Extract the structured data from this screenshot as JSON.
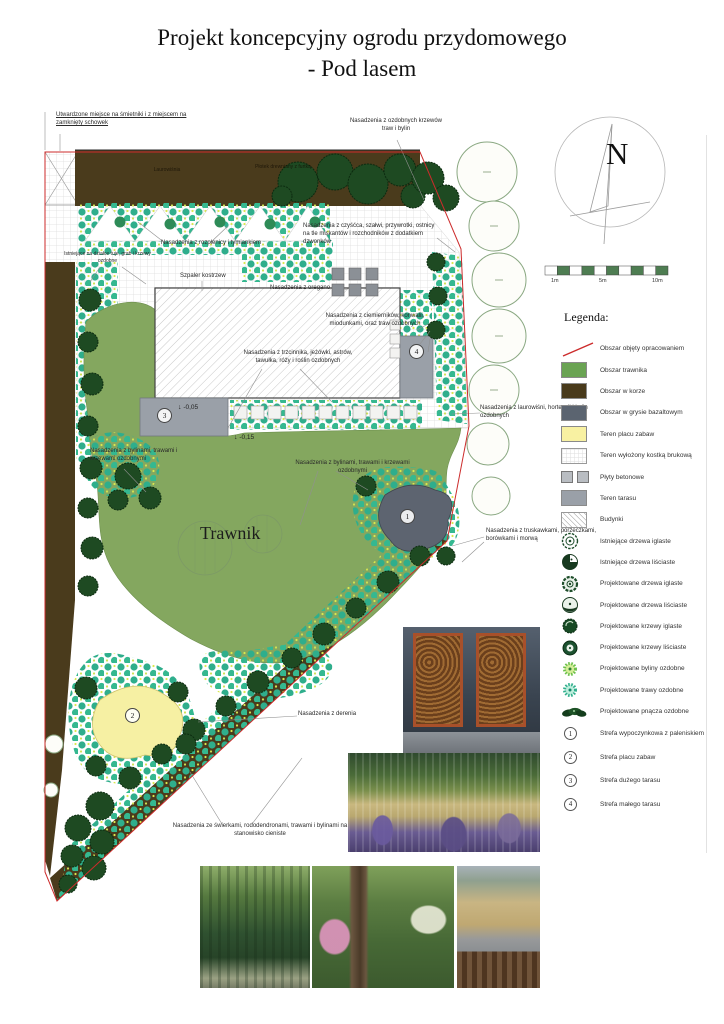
{
  "title": {
    "line1": "Projekt koncepcyjny ogrodu przydomowego",
    "line2": "- Pod lasem"
  },
  "compass": {
    "label": "N"
  },
  "scale_bar": {
    "labels": [
      "1m",
      "5m",
      "10m"
    ]
  },
  "legend": {
    "title": "Legenda:",
    "items": [
      {
        "swatch": "boundary-line",
        "label": "Obszar objęty opracowaniem"
      },
      {
        "swatch": "lawn",
        "label": "Obszar trawnika"
      },
      {
        "swatch": "bark",
        "label": "Obszar w korze"
      },
      {
        "swatch": "basalt",
        "label": "Obszar w grysie bazaltowym"
      },
      {
        "swatch": "playground",
        "label": "Teren placu zabaw"
      },
      {
        "swatch": "pavers",
        "label": "Teren wyłożony kostką brukową"
      },
      {
        "swatch": "concrete-slabs",
        "label": "Płyty betonowe"
      },
      {
        "swatch": "terrace",
        "label": "Teren tarasu"
      },
      {
        "swatch": "building",
        "label": "Budynki"
      },
      {
        "swatch": "existing-conifer-tree",
        "label": "Istniejące drzewa iglaste"
      },
      {
        "swatch": "existing-deciduous-tree",
        "label": "Istniejące drzewa liściaste"
      },
      {
        "swatch": "proposed-conifer-tree",
        "label": "Projektowane drzewa iglaste"
      },
      {
        "swatch": "proposed-deciduous-tree",
        "label": "Projektowane drzewa liściaste"
      },
      {
        "swatch": "proposed-conifer-shrub",
        "label": "Projektowane krzewy iglaste"
      },
      {
        "swatch": "proposed-deciduous-shrub",
        "label": "Projektowane krzewy liściaste"
      },
      {
        "swatch": "ornamental-perennials",
        "label": "Projektowane byliny ozdobne"
      },
      {
        "swatch": "ornamental-grasses",
        "label": "Projektowane trawy ozdobne"
      },
      {
        "swatch": "ornamental-climbers",
        "label": "Projektowane pnącza ozdobne"
      },
      {
        "number": "1",
        "label": "Strefa wypoczynkowa z paleniskiem"
      },
      {
        "number": "2",
        "label": "Strefa placu zabaw"
      },
      {
        "number": "3",
        "label": "Strefa dużego tarasu"
      },
      {
        "number": "4",
        "label": "Strefa małego tarasu"
      }
    ]
  },
  "plan": {
    "lawn_label": "Trawnik",
    "annotations": [
      "Utwardzone miejsce na śmietniki i z miejscem na zamknięty schowek",
      "Nasadzenia z ozdobnych krzewów traw i bylin",
      "Nasadzenia z rozplenicy i tymiankiem",
      "Istniejące na działce tuje, grab i krzewy ozdobne",
      "Nasadzenia z czyśćca, szałwi, przywrotki, ostnicy na tle miskantów i rozchodników z dodatkiem dzwonków",
      "Szpaler kostrzew",
      "Nasadzenia z oregano",
      "Nasadzenia z ciemierników, konwalii, miodunkami, oraz traw ozdobnych",
      "Nasadzenia z trzcinnika, jeżówki, astrów, tawułka, róży i roślin ozdobnych",
      "Nasadzenia z laurowiśni, hortensji i bylin ozdobnych",
      "Nasadzenia z bylinami, trawami i krzewami ozdobnymi",
      "Nasadzenia z bylinami, trawami i krzewami ozdobnymi",
      "Nasadzenia z truskawkami, porzeczkami, borówkami i morwą",
      "Nasadzenia z derenia",
      "Nasadzenia ze świerkami, rododendronami, trawami i bylinami na stanowisko cieniste",
      "Laurowiśnia",
      "Płotek drewniany z furtką"
    ],
    "elevations": [
      "-0,05",
      "-0,15"
    ],
    "zones": [
      {
        "number": "1"
      },
      {
        "number": "2"
      },
      {
        "number": "3"
      },
      {
        "number": "4"
      }
    ]
  },
  "colors": {
    "lawn_green": "#84a75f",
    "shrub_teal": "#2fae8c",
    "bark_brown": "#4a3b1c",
    "basalt_gray": "#5b6470",
    "playground_yellow": "#f6f0a3",
    "terrace_gray": "#9aa0a8",
    "boundary_red": "#cc2b2b",
    "tree_dark_green": "#1e4a22",
    "legend_green": "#6aa353"
  }
}
